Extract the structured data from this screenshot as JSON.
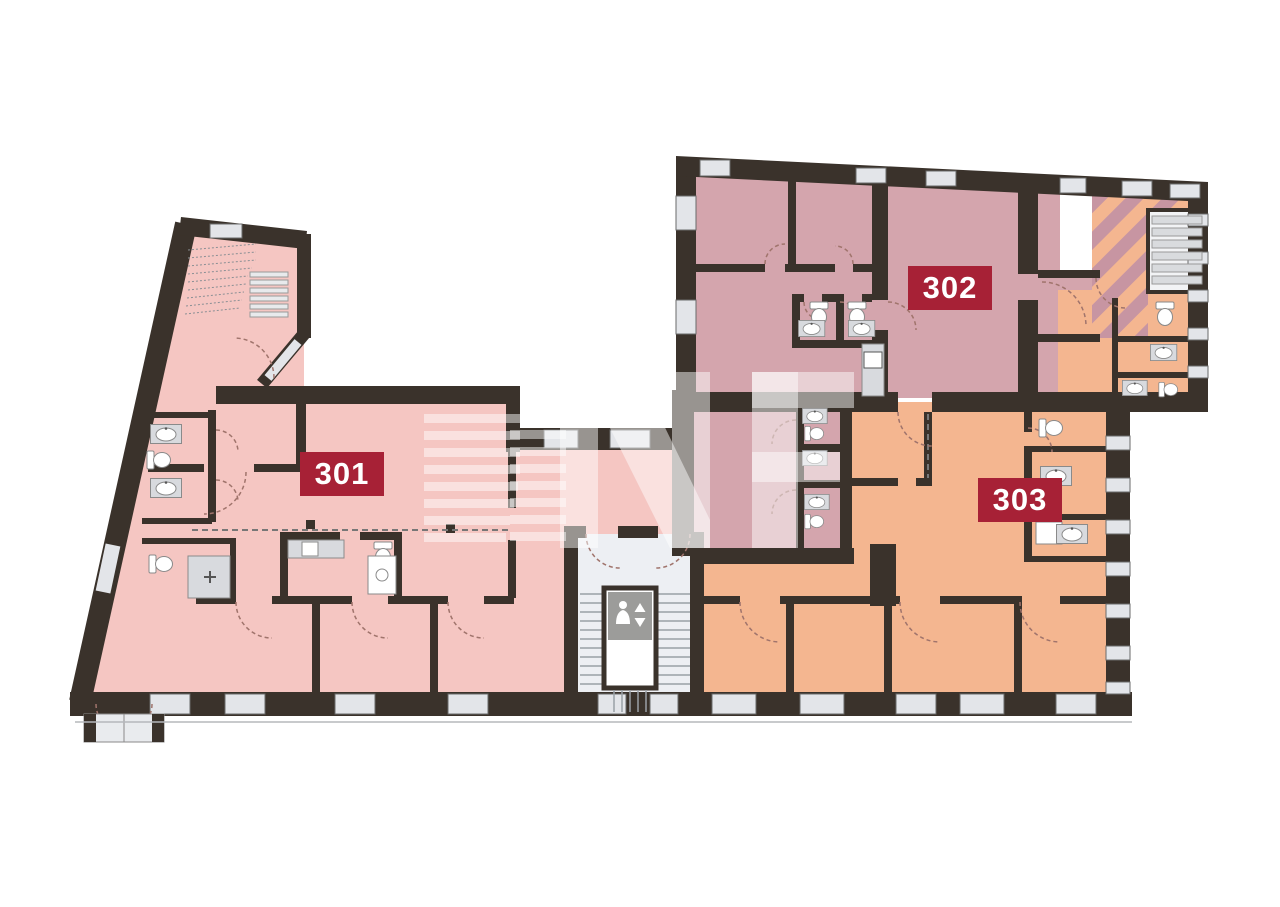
{
  "plan": {
    "title": "floor-plan",
    "floor_units": [
      {
        "id": "301",
        "label": "301"
      },
      {
        "id": "302",
        "label": "302"
      },
      {
        "id": "303",
        "label": "303"
      }
    ],
    "watermark": {
      "letters": "NF",
      "style": "striped-emblem-plus-letters"
    },
    "palette": {
      "wall": "#3a322b",
      "unit_301": "#f5c6c2",
      "unit_302": "#d4a5ad",
      "unit_303": "#f4b690",
      "hatch_stripe": "#c795a2",
      "badge_bg": "#a72136",
      "badge_text": "#ffffff",
      "window": "#e3e5e9",
      "lobby": "#edeff3",
      "fixture_gray": "#d8dade",
      "door_arc": "#a0746c"
    },
    "icons": {
      "elevator": "elevator-passenger-icon",
      "toilet": "toilet-icon",
      "sink": "sink-icon"
    }
  }
}
